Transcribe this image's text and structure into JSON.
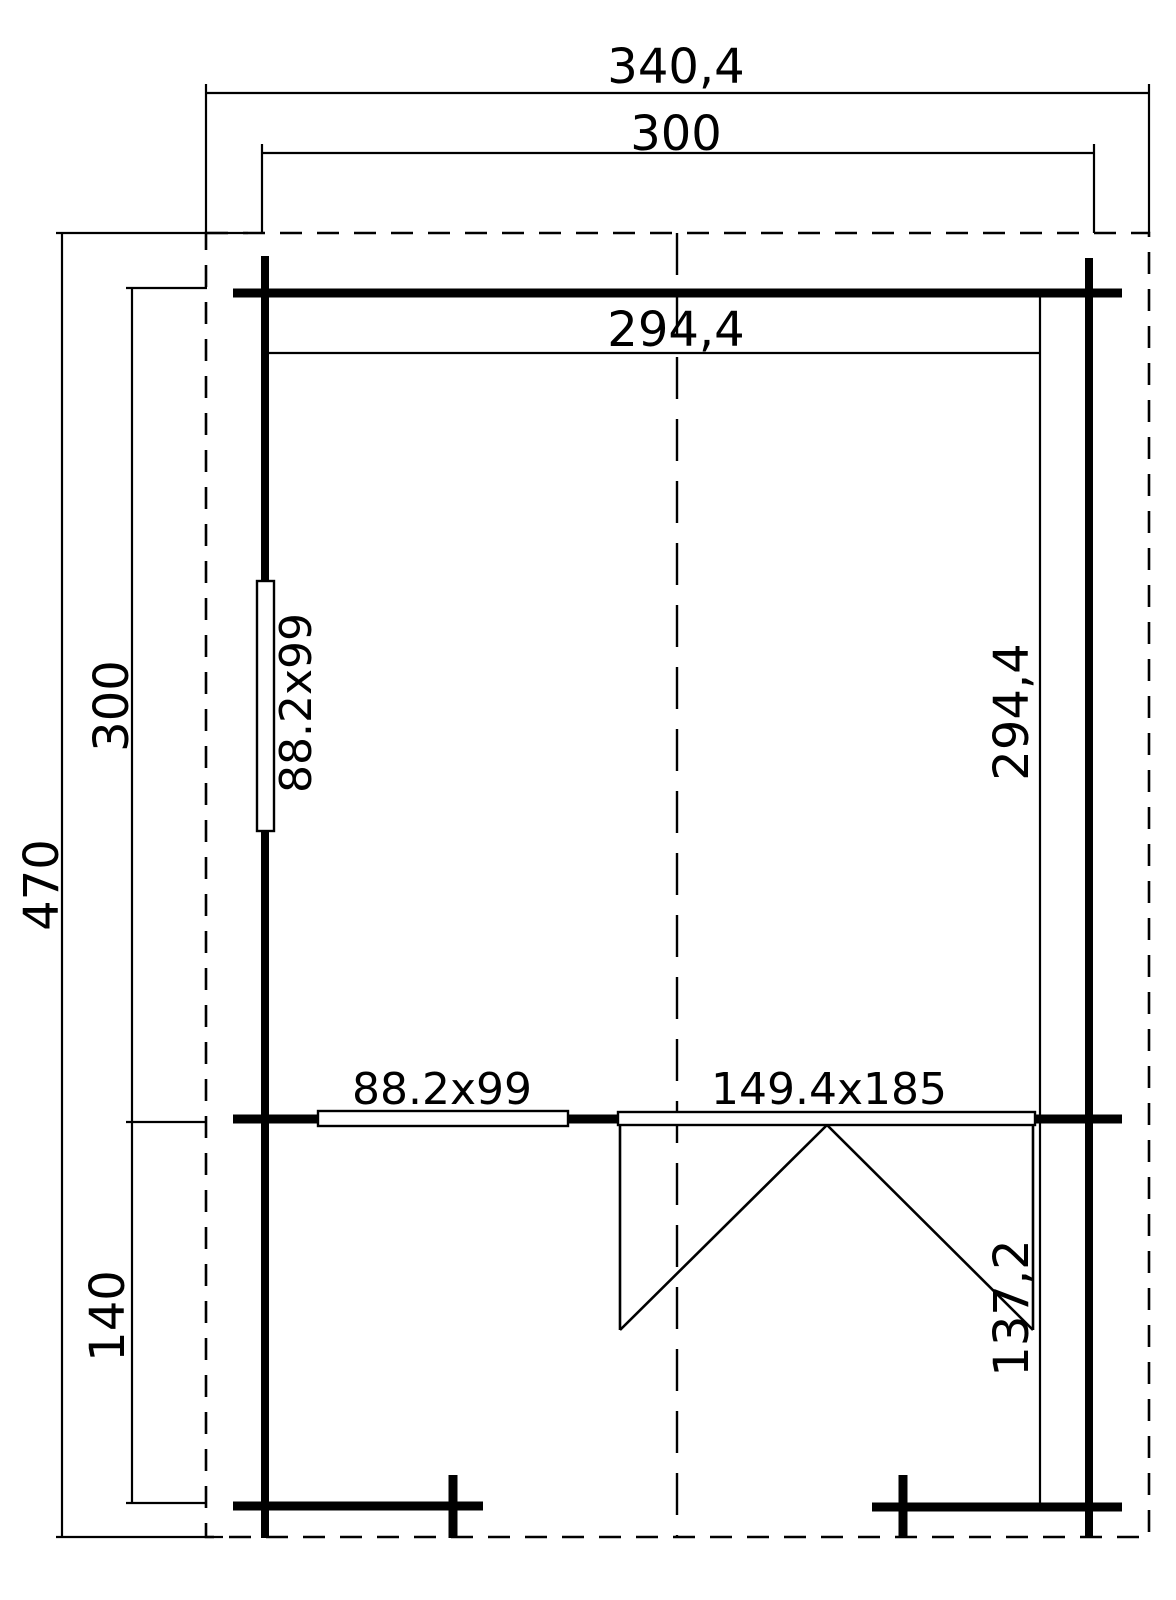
{
  "plan": {
    "title": "log-cabin-floor-plan",
    "colors": {
      "line": "#000000",
      "background": "#ffffff"
    },
    "top": {
      "overall_width": "340,4",
      "outer_width": "300",
      "inner_width": "294,4"
    },
    "left": {
      "overall_depth": "470",
      "cabin_depth": "300",
      "porch_depth": "140",
      "side_window": "88.2x99"
    },
    "right": {
      "inner_depth": "294,4",
      "porch_inner_depth": "137,2"
    },
    "front": {
      "front_window": "88.2x99",
      "double_door": "149.4x185"
    }
  }
}
